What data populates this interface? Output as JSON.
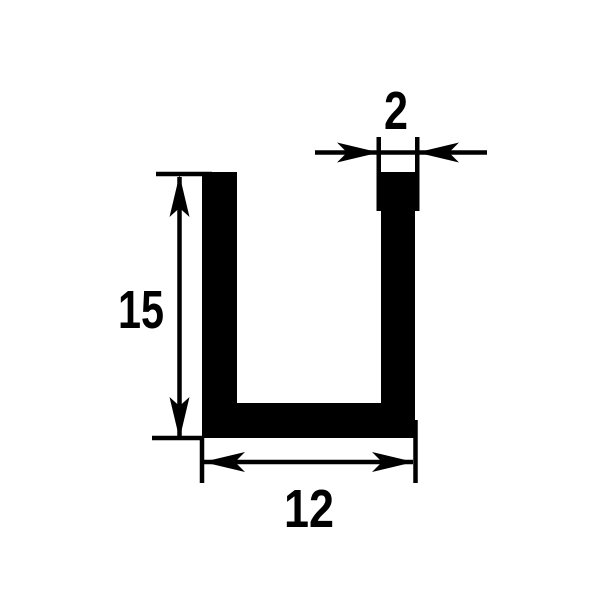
{
  "drawing": {
    "subject": "U-channel profile cross-section technical drawing",
    "dimensions": {
      "height_label": "15",
      "width_label": "12",
      "thickness_label": "2"
    },
    "colors": {
      "ink": "#000000",
      "background": "#ffffff"
    }
  }
}
